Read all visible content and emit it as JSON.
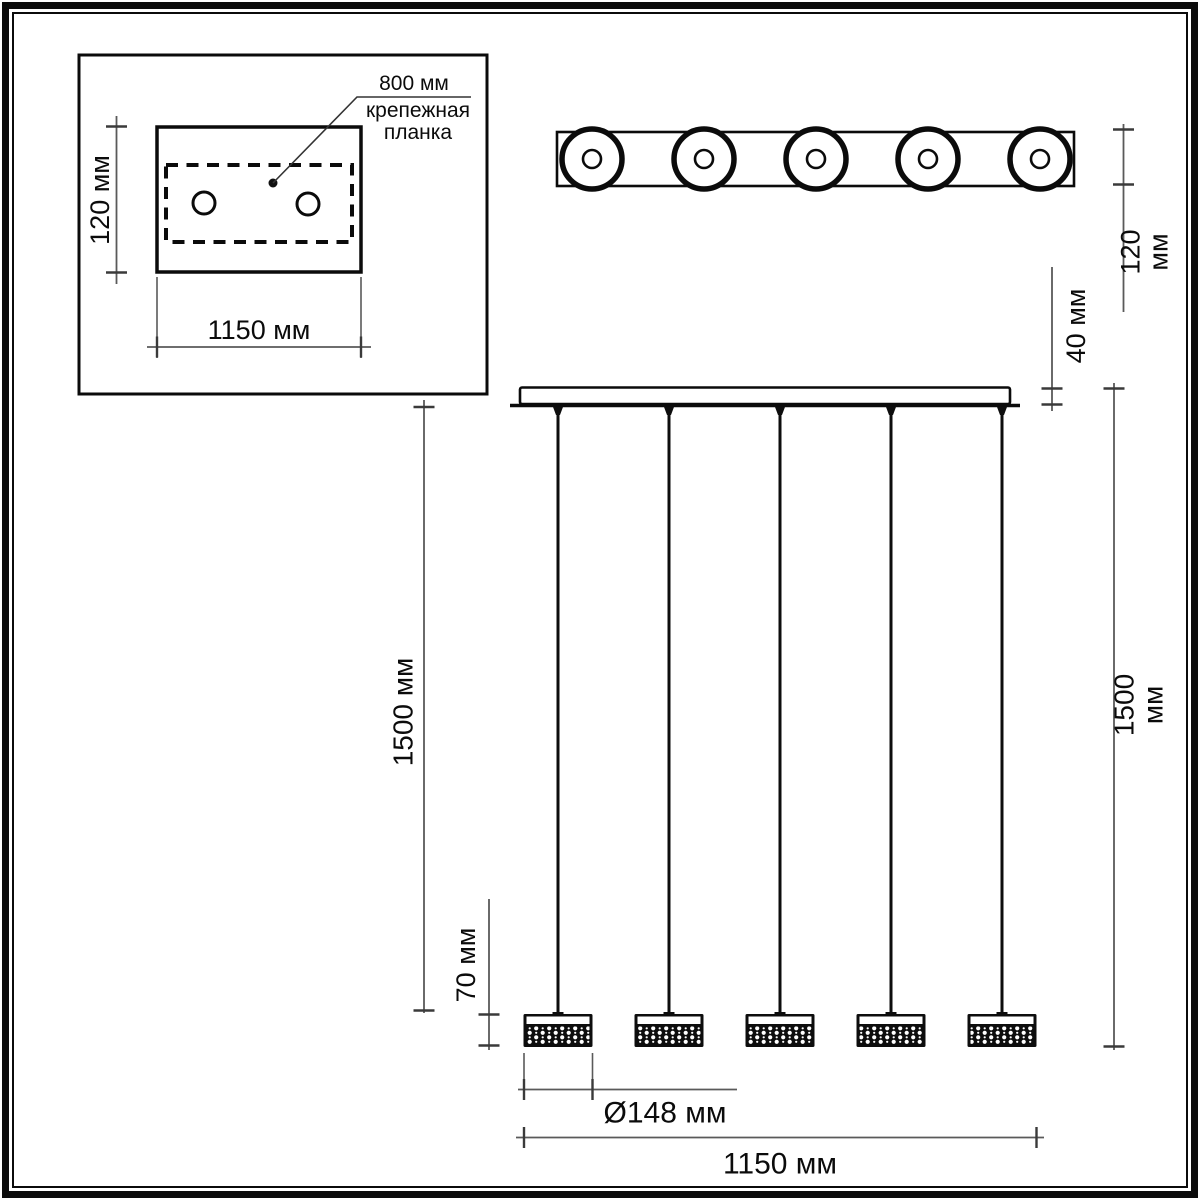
{
  "drawing": {
    "kind": "pendant-light-dimension-diagram",
    "shade_count": 5,
    "mount_hole_count": 2
  },
  "colors": {
    "line": "#0b0b0b",
    "dimension": "#5a5a5a",
    "tick": "#3a3a3a",
    "background": "#ffffff"
  },
  "inset_view": {
    "mount_plate_length_label": "800 мм",
    "mount_plate_name": "крепежная\nпланка",
    "height_label": "120 мм",
    "width_label": "1150 мм"
  },
  "top_view": {
    "height_label": "120 мм"
  },
  "front_view": {
    "canopy_height_label": "40 мм",
    "cable_drop_left_label": "1500 мм",
    "cable_drop_right_label": "1500 мм",
    "shade_height_label": "70 мм",
    "shade_diameter_label": "Ø148 мм",
    "total_width_label": "1150 мм"
  }
}
